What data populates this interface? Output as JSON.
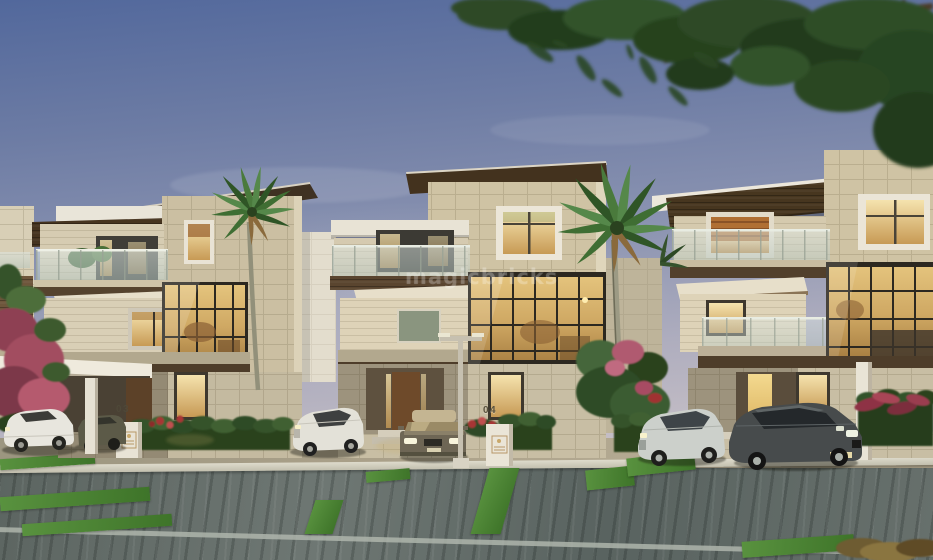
{
  "image": {
    "kind": "architectural-3d-render",
    "description": "Dusk exterior rendering of a row of modern three-storey luxury villas with stone facades, glass balconies, warm lit windows, palm trees, trimmed hedges and luxury sedans parked along a grey paver driveway, beneath an overhanging tree"
  },
  "watermark": {
    "text": "magicbricks"
  },
  "house_numbers": {
    "left": "03",
    "middle": "04"
  },
  "scene": {
    "elements": [
      "sky",
      "overhanging-tree",
      "left-neighbor-building",
      "villa-left",
      "villa-middle",
      "villa-right",
      "palm-tree-left",
      "palm-tree-middle",
      "bougainvillea-left",
      "hedges",
      "flower-beds",
      "number-pedestals",
      "street-lamp",
      "carport",
      "parked-cars",
      "driveway-apron",
      "curb",
      "paver-road",
      "grass-strips"
    ],
    "car_colors": [
      "white",
      "olive-grey",
      "white",
      "gold-beige",
      "silver",
      "dark-grey",
      "grey-partial"
    ]
  },
  "palette": {
    "sky_top": "#52689c",
    "sky_horizon": "#d4cac7",
    "stone_wall": "#cfc3a4",
    "cream_wall": "#ded3b8",
    "wood_fascia": "#47351f",
    "white_slab": "#ece7db",
    "window_glow": "#eed49b",
    "glass_mullion": "#2c2820",
    "balcony_glass": "#c2d2cd",
    "foliage_dark": "#2a4424",
    "foliage_light": "#548740",
    "hedge": "#35522c",
    "road": "#646d6a",
    "grass_strip": "#4f8c38",
    "flower_pink": "#b55a6e",
    "flower_red": "#a03030"
  }
}
